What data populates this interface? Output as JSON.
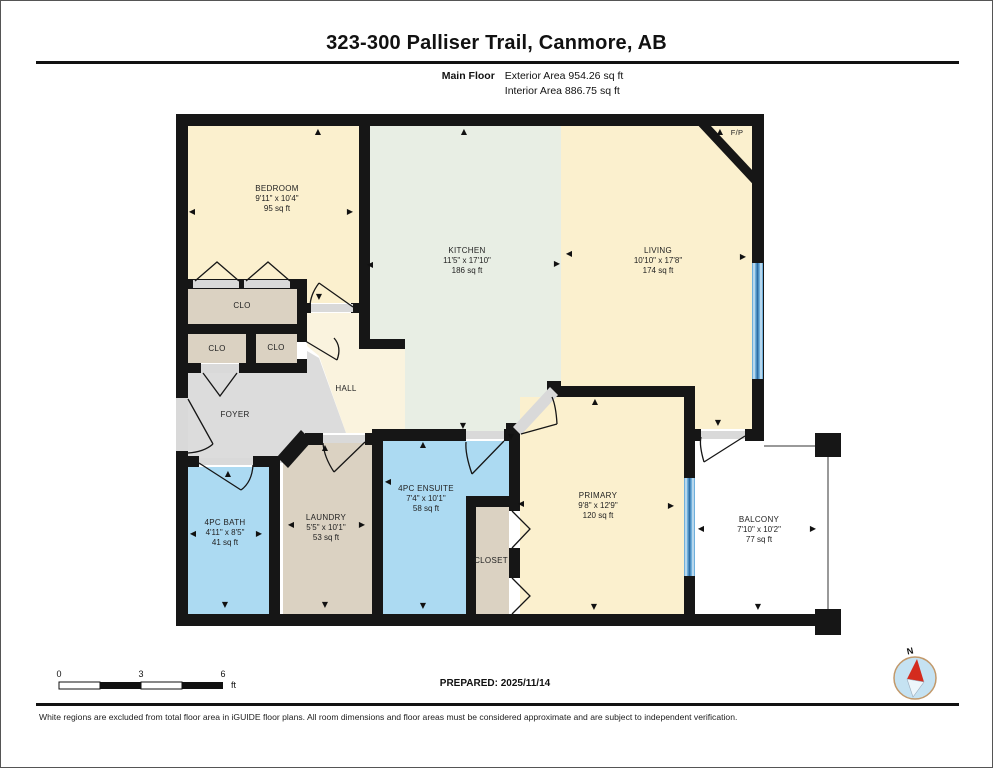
{
  "header": {
    "title": "323-300 Palliser Trail, Canmore, AB",
    "floor_label": "Main Floor",
    "exterior_area": "Exterior Area 954.26 sq ft",
    "interior_area": "Interior Area 886.75 sq ft"
  },
  "rooms": {
    "bedroom": {
      "name": "BEDROOM",
      "dims": "9'11\" x 10'4\"",
      "area": "95 sq ft"
    },
    "kitchen": {
      "name": "KITCHEN",
      "dims": "11'5\" x 17'10\"",
      "area": "186 sq ft"
    },
    "living": {
      "name": "LIVING",
      "dims": "10'10\" x 17'8\"",
      "area": "174 sq ft"
    },
    "primary": {
      "name": "PRIMARY",
      "dims": "9'8\" x 12'9\"",
      "area": "120 sq ft"
    },
    "ensuite": {
      "name": "4PC ENSUITE",
      "dims": "7'4\" x 10'1\"",
      "area": "58 sq ft"
    },
    "bath": {
      "name": "4PC BATH",
      "dims": "4'11\" x 8'5\"",
      "area": "41 sq ft"
    },
    "laundry": {
      "name": "LAUNDRY",
      "dims": "5'5\" x 10'1\"",
      "area": "53 sq ft"
    },
    "balcony": {
      "name": "BALCONY",
      "dims": "7'10\" x 10'2\"",
      "area": "77 sq ft"
    },
    "hall": {
      "name": "HALL"
    },
    "foyer": {
      "name": "FOYER"
    },
    "closet": {
      "name": "CLOSET"
    },
    "clo": {
      "name": "CLO"
    },
    "fireplace": {
      "name": "F/P"
    }
  },
  "scale_bar": {
    "ticks": [
      "0",
      "3",
      "6"
    ],
    "unit": "ft"
  },
  "compass": {
    "north_label": "N"
  },
  "footer": {
    "prepared": "PREPARED: 2025/11/14",
    "disclaimer": "White regions are excluded from total floor area in iGUIDE floor plans. All room dimensions and floor areas must be considered approximate and are subject to independent verification."
  },
  "colors": {
    "wall": "#161616",
    "room_cream": "#FBF0CE",
    "room_hall": "#FAF3DE",
    "room_kitchen": "#E8EEE4",
    "room_tan": "#DBD2C2",
    "room_gray": "#DCDCDC",
    "room_blue": "#ACDAF2",
    "window_blue": "#6FAFDB",
    "window_line": "#2E6DA4",
    "door_sill": "#D9D9D9",
    "compass_red": "#D42B1E"
  }
}
